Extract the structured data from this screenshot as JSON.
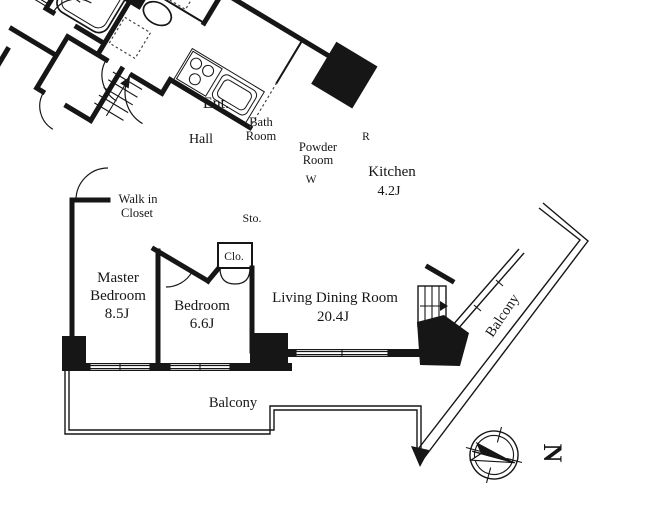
{
  "title": "Apartment floor plan",
  "rooms": {
    "master_bedroom": {
      "label": "Master Bedroom",
      "area": "8.5J",
      "lines": [
        "Master",
        "Bedroom",
        "8.5J"
      ]
    },
    "bedroom": {
      "label": "Bedroom",
      "area": "6.6J"
    },
    "living_dining": {
      "label": "Living Dining Room",
      "area": "20.4J"
    },
    "kitchen": {
      "label": "Kitchen",
      "area": "4.2J"
    },
    "bath": {
      "label": "Bath Room",
      "lines": [
        "Bath",
        "Room"
      ]
    },
    "powder": {
      "label": "Powder Room",
      "lines": [
        "Powder",
        "Room"
      ]
    },
    "entrance": {
      "label": "Ent."
    },
    "hall": {
      "label": "Hall"
    },
    "shoes_closet": {
      "label": "Shoes Clo.",
      "lines": [
        "Shoes",
        "Clo."
      ]
    },
    "walk_in_closet": {
      "label": "Walk in Closet",
      "lines": [
        "Walk in",
        "Closet"
      ]
    },
    "storage": {
      "label": "Sto."
    },
    "closet": {
      "label": "Clo."
    }
  },
  "balconies": {
    "bottom": "Balcony",
    "right": "Balcony"
  },
  "markers": {
    "washer": "W",
    "refrigerator": "R",
    "north": "N"
  },
  "colors": {
    "wall": "#161616",
    "background": "#ffffff"
  }
}
